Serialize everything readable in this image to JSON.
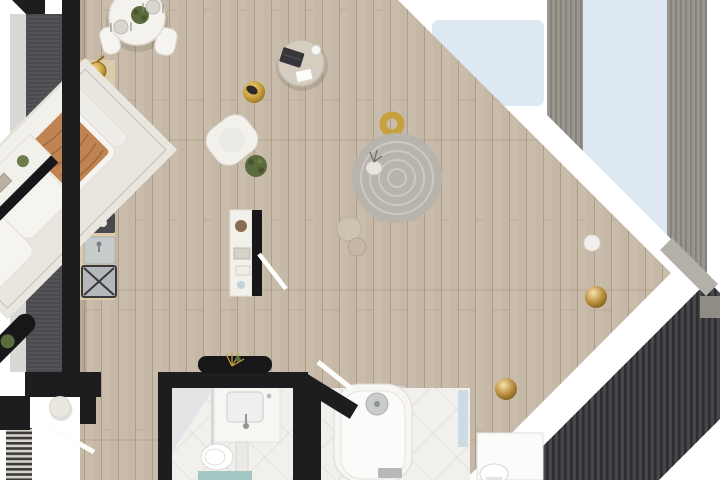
{
  "scene": {
    "kind": "3d-rendered apartment floor plan, top-down view",
    "orientation": "diagonal glazed facade running upper-left to lower-right"
  },
  "palette": {
    "background": "#ffffff",
    "wall": "#1d1d20",
    "floor_wood": "#c6b8a6",
    "counter_wood": "#dccbab",
    "facade_gray": "#9a958d",
    "facade_dark": "#4b4b4f",
    "stripes_dark": "#46464b",
    "glass_blue": "#dde8f3",
    "light_gray_strip": "#d9d8d5",
    "rug_living": "#e8e6df",
    "rug_bedroom": "#e2dcce",
    "rug_round": "#b8b4ac",
    "tile_white": "#f1f0ed",
    "gold": "#c6a13e",
    "orange_throw": "#c08452",
    "taupe_blanket": "#94846f",
    "bed_duvet": "#d6cfc2",
    "teal_mat": "#a3c7c4",
    "plant_green": "#5a6c3e",
    "white_furniture": "#f4f2ed",
    "chamfer_gray": "#b3afa9",
    "console_dark": "#17171a"
  },
  "rooms": [
    {
      "name": "kitchen",
      "furniture": [
        "kitchen-counter",
        "cooktop-4-burner",
        "cutting-board",
        "coffee-machine",
        "sink",
        "appliance-x-module",
        "gold-pot"
      ]
    },
    {
      "name": "dining-area",
      "furniture": [
        "round-dining-table",
        "dining-chairs-x4",
        "table-plant",
        "place-settings-x2"
      ]
    },
    {
      "name": "living-room",
      "furniture": [
        "area-rug",
        "modular-sofa",
        "orange-fringe-throw",
        "round-coffee-table",
        "laptop",
        "gold-pouf",
        "armchair",
        "floor-plant",
        "media-console-gold",
        "gold-ring-decor",
        "leaning-picture-frames"
      ]
    },
    {
      "name": "bedroom-1",
      "furniture": [
        "double-bed-gold-throw",
        "round-gray-rug",
        "vase-with-branches",
        "floor-poufs-x2",
        "dark-wall-console-with-plant",
        "open-wardrobe-hangers",
        "shelf-partition",
        "open-door"
      ]
    },
    {
      "name": "bedroom-2",
      "furniture": [
        "double-bed-taupe-blanket",
        "area-rug",
        "nightstands-x2",
        "gold-sphere-lamps-x2",
        "vanity-desk",
        "stool",
        "open-wardrobes-x2",
        "clothes-bench",
        "clothes-pile"
      ]
    },
    {
      "name": "bathroom",
      "furniture": [
        "vanity-sink",
        "toilet",
        "teal-bath-mat",
        "shower-glass-panel"
      ]
    },
    {
      "name": "bathtub-room",
      "furniture": [
        "bathtub",
        "glass-screen",
        "open-door"
      ]
    },
    {
      "name": "wc-niche",
      "furniture": [
        "toilet"
      ]
    },
    {
      "name": "entry-hall",
      "furniture": [
        "open-entry-door",
        "round-pouf",
        "striped-doormat",
        "dark-console-dried-flowers"
      ]
    },
    {
      "name": "exterior",
      "furniture": [
        "glazed-balcony-panels",
        "facade-strips",
        "diagonal-window-wall"
      ]
    }
  ]
}
